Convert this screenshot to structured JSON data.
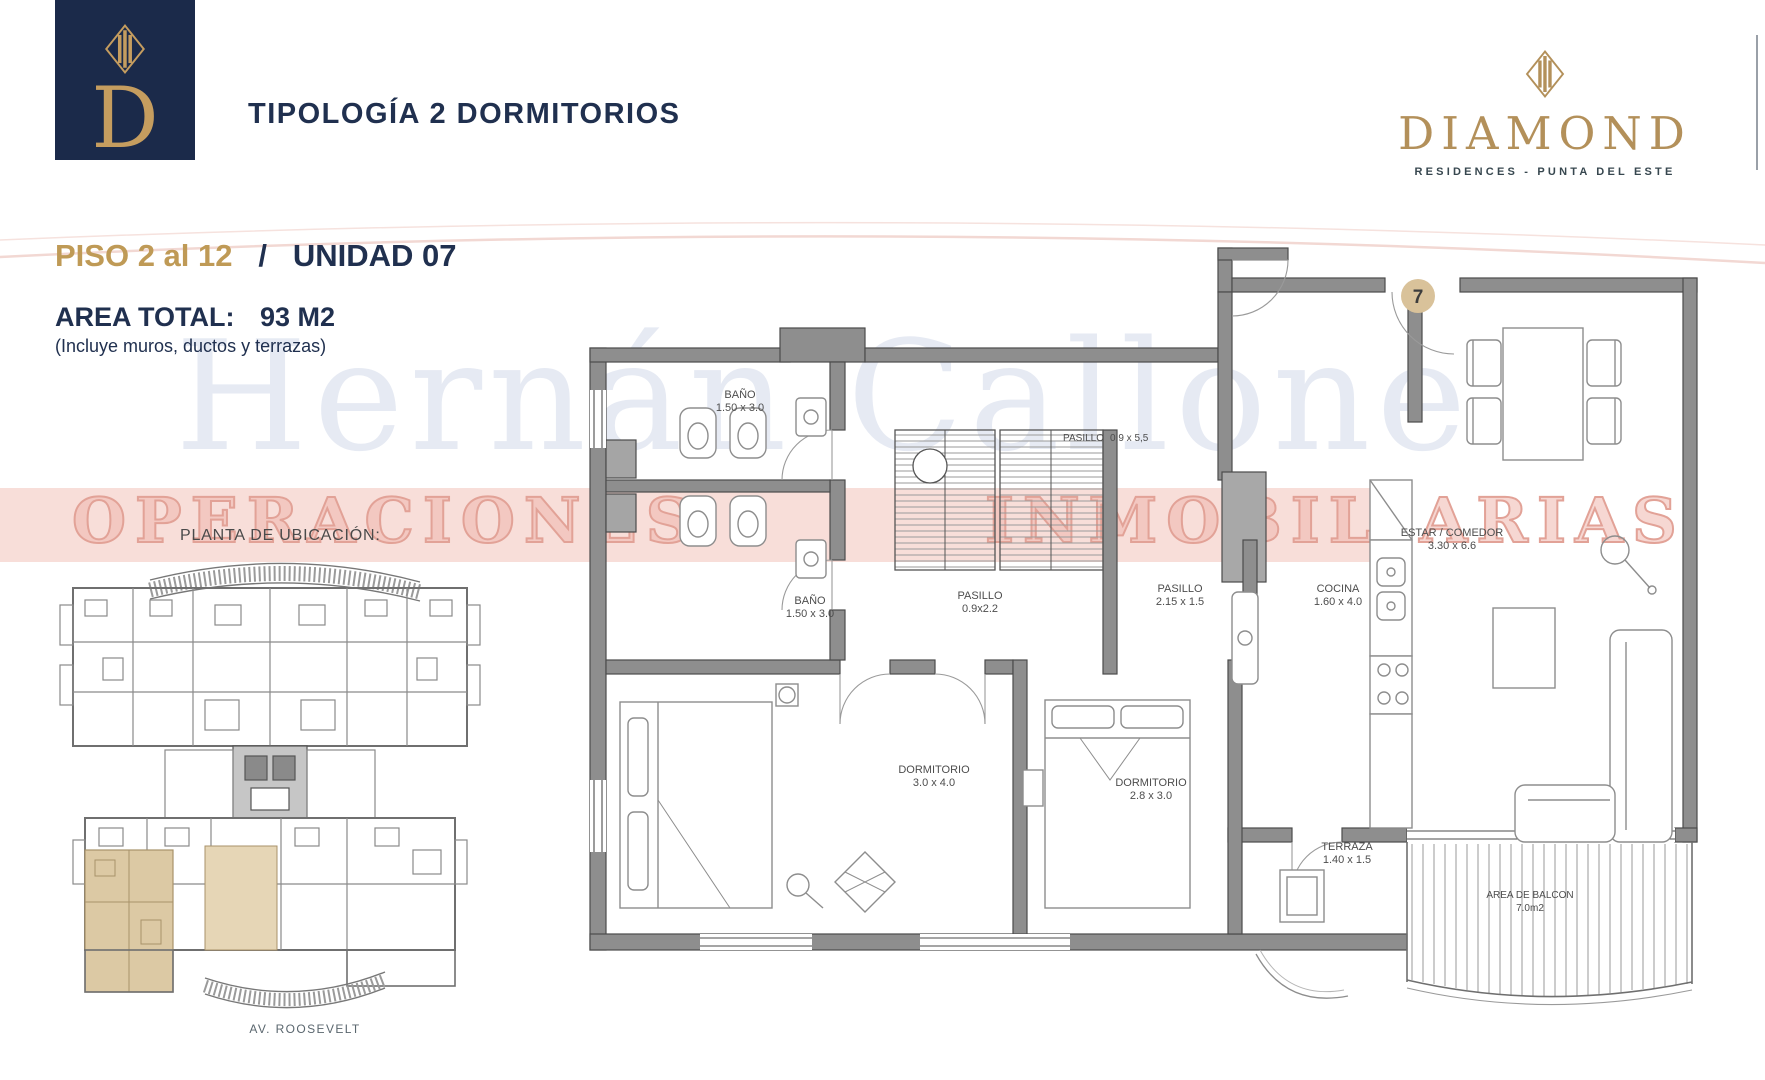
{
  "header": {
    "logo_letter": "D",
    "title": "TIPOLOGÍA 2 DORMITORIOS",
    "brand_name": "DIAMOND",
    "brand_tagline": "RESIDENCES - PUNTA DEL ESTE"
  },
  "info": {
    "floor": "PISO 2 al 12",
    "separator": "/",
    "unit": "UNIDAD 07",
    "area_label": "AREA TOTAL:",
    "area_value": "93 M2",
    "area_note": "(Incluye muros, ductos y terrazas)"
  },
  "location": {
    "label": "PLANTA DE UBICACIÓN:",
    "street": "AV. ROOSEVELT"
  },
  "unit_badge": "7",
  "watermark": {
    "name": "Hernán Callone",
    "word_left": "OPERACIONES",
    "word_right": "INMOBILIARIAS"
  },
  "rooms": {
    "bano1": {
      "name": "BAÑO",
      "dims": "1.50 x 3.0"
    },
    "pasillo1": {
      "name": "PASILLO",
      "dims": "0.9 x 5,5"
    },
    "bano2": {
      "name": "BAÑO",
      "dims": "1.50 x 3.0"
    },
    "pasillo2": {
      "name": "PASILLO",
      "dims": "0.9x2.2"
    },
    "pasillo3": {
      "name": "PASILLO",
      "dims": "2.15 x 1.5"
    },
    "cocina": {
      "name": "COCINA",
      "dims": "1.60 x 4.0"
    },
    "estar": {
      "name": "ESTAR / COMEDOR",
      "dims": "3.30 x 6.6"
    },
    "dorm1": {
      "name": "DORMITORIO",
      "dims": "3.0 x 4.0"
    },
    "dorm2": {
      "name": "DORMITORIO",
      "dims": "2.8 x 3.0"
    },
    "terraza": {
      "name": "TERRAZA",
      "dims": "1.40 x 1.5"
    },
    "balcon": {
      "name": "AREA DE BALCON",
      "dims": "7.0m2"
    }
  },
  "colors": {
    "navy": "#20304f",
    "gold": "#bf9a56",
    "brand_gold": "#b3905a",
    "wall_gray": "#8e8e8e",
    "badge_tan": "#d9c29a",
    "highlight_beige": "#dcc9a4",
    "watermark_pink": "#f8ded9"
  }
}
